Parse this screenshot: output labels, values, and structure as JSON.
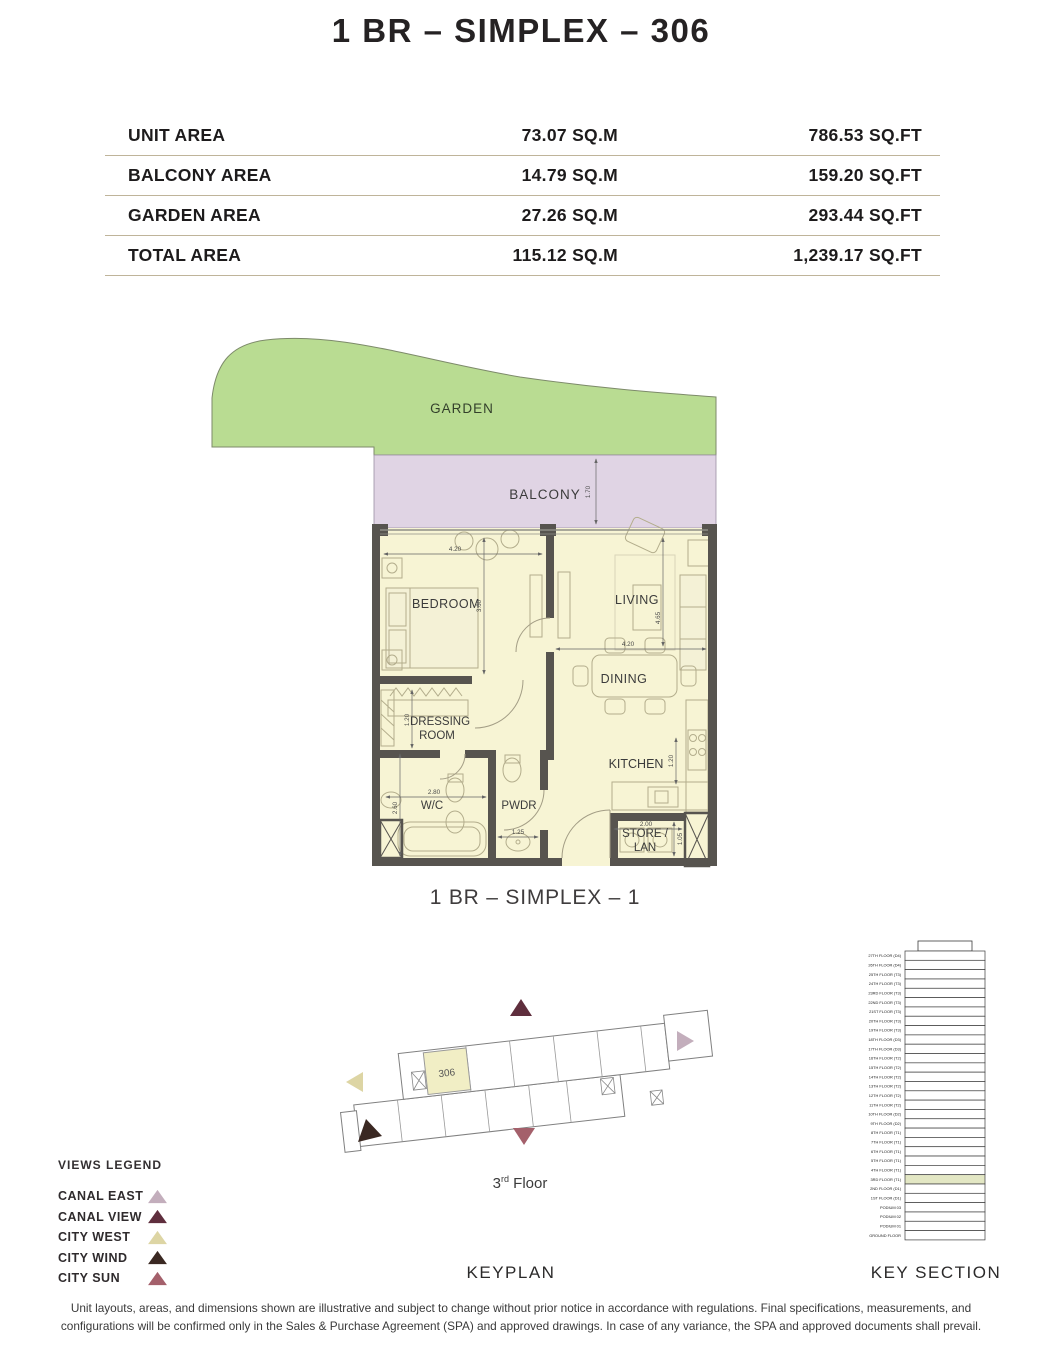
{
  "title": "1 BR – SIMPLEX – 306",
  "area_table": {
    "rows": [
      {
        "label": "UNIT AREA",
        "sqm": "73.07 SQ.M",
        "sqft": "786.53 SQ.FT"
      },
      {
        "label": "BALCONY AREA",
        "sqm": "14.79 SQ.M",
        "sqft": "159.20 SQ.FT"
      },
      {
        "label": "GARDEN AREA",
        "sqm": "27.26 SQ.M",
        "sqft": "293.44 SQ.FT"
      },
      {
        "label": "TOTAL AREA",
        "sqm": "115.12 SQ.M",
        "sqft": "1,239.17 SQ.FT"
      }
    ]
  },
  "floor_plan": {
    "caption": "1 BR – SIMPLEX – 1",
    "rooms": {
      "garden": "GARDEN",
      "balcony": "BALCONY",
      "bedroom": "BEDROOM",
      "living": "LIVING",
      "dining": "DINING",
      "dressing_line1": "DRESSING",
      "dressing_line2": "ROOM",
      "wc": "W/C",
      "pwdr": "PWDR",
      "kitchen": "KITCHEN",
      "store_line1": "STORE /",
      "store_line2": "LAN"
    },
    "dimensions": {
      "balcony_depth": "1.70",
      "bedroom_width": "4.20",
      "bedroom_height": "3.60",
      "living_width": "4.20",
      "living_height": "4.65",
      "dressing_width": "1.20",
      "wc_width": "2.80",
      "wc_height": "2.60",
      "pwdr_width": "1.25",
      "kitchen_depth": "1.20",
      "store_width": "2.00",
      "store_height": "1.05"
    },
    "colors": {
      "garden": "#b9dc92",
      "balcony": "#e0d4e4",
      "room": "#f7f4d4",
      "wall": "#57544f"
    }
  },
  "keyplan": {
    "section_label": "KEYPLAN",
    "unit_number": "306",
    "unit_highlight_color": "#f1eec5",
    "floor_num": "3",
    "floor_ordinal": "rd",
    "floor_word": " Floor",
    "arrows": {
      "top": "#5f2e3d",
      "right": "#c3aebc",
      "left": "#ddd5a4",
      "bottom_left": "#3a2822",
      "bottom": "#a4606b"
    }
  },
  "views_legend": {
    "title": "VIEWS LEGEND",
    "items": [
      {
        "label": "CANAL EAST",
        "color": "#c3aebc"
      },
      {
        "label": "CANAL VIEW",
        "color": "#5f2e3d"
      },
      {
        "label": "CITY WEST",
        "color": "#ddd5a4"
      },
      {
        "label": "CITY WIND",
        "color": "#3a2822"
      },
      {
        "label": "CITY SUN",
        "color": "#a4606b"
      }
    ]
  },
  "key_section": {
    "section_label": "KEY SECTION",
    "highlighted_floor": "3RD FLOOR (T1)",
    "highlight_color": "#e3e7c4",
    "floors": [
      "27TH FLOOR (D4)",
      "26TH FLOOR (D4)",
      "25TH FLOOR (T3)",
      "24TH FLOOR (T3)",
      "23RD FLOOR (T3)",
      "22ND FLOOR (T3)",
      "21ST FLOOR (T3)",
      "20TH FLOOR (T3)",
      "19TH FLOOR (T3)",
      "18TH FLOOR (D3)",
      "17TH FLOOR (D3)",
      "16TH FLOOR (T2)",
      "15TH FLOOR (T2)",
      "14TH FLOOR (T2)",
      "13TH FLOOR (T2)",
      "12TH FLOOR (T2)",
      "11TH FLOOR (T2)",
      "10TH FLOOR (D2)",
      "9TH FLOOR (D2)",
      "8TH FLOOR (T1)",
      "7TH FLOOR (T1)",
      "6TH FLOOR (T1)",
      "5TH FLOOR (T1)",
      "4TH FLOOR (T1)",
      "3RD FLOOR (T1)",
      "2ND FLOOR (D1)",
      "1ST FLOOR (D1)",
      "PODIUM 03",
      "PODIUM 02",
      "PODIUM 01",
      "GROUND FLOOR"
    ]
  },
  "disclaimer": "Unit layouts, areas, and dimensions shown are illustrative and subject to change without prior notice in accordance with regulations. Final specifications, measurements, and configurations will be confirmed only in the Sales & Purchase Agreement (SPA) and approved drawings. In case of any variance, the SPA and approved documents shall prevail."
}
